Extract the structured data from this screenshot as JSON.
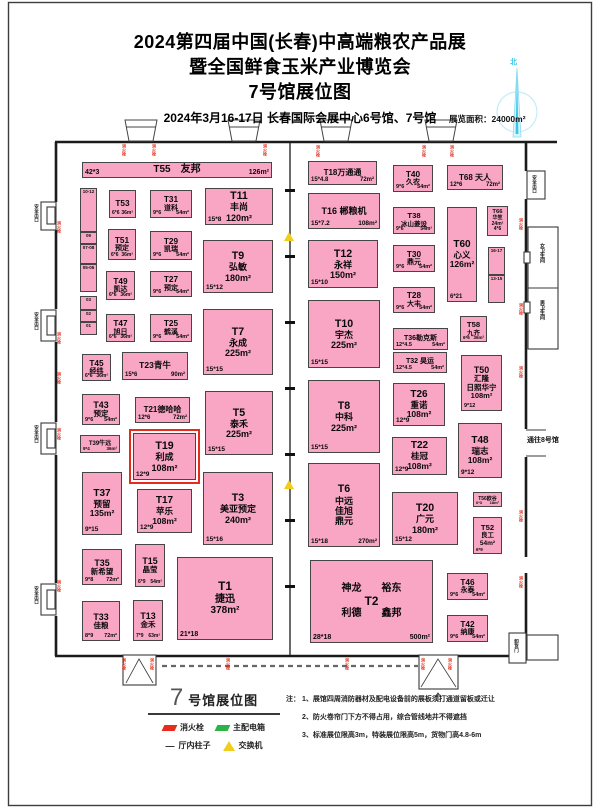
{
  "header": {
    "title1": "2024第四届中国(长春)中高端粮农产品展",
    "title2": "暨全国鲜食玉米产业博览会",
    "title3": "7号馆展位图",
    "date": "2024年3月16-17日  长春国际会展中心6号馆、7号馆",
    "area": "展览面积：24000m²",
    "compass": "北"
  },
  "colors": {
    "booth_pink": "#F8A6C3",
    "highlight_red": "#E62C1C",
    "hydrant_red": "#DD1414",
    "switch_yellow": "#F2CE1C",
    "distribution_green": "#2DB24A",
    "compass_cyan": "#39C6EA"
  },
  "map": {
    "booths": [
      {
        "id": "T55",
        "x": 82,
        "y": 162,
        "w": 190,
        "h": 16,
        "fs": 10,
        "cfs": 7,
        "lines": [
          "T55　友邦"
        ],
        "bl": "42*3",
        "br": "126m²"
      },
      {
        "id": "T53",
        "x": 109,
        "y": 190,
        "w": 27,
        "h": 28,
        "fs": 7,
        "cfs": 5,
        "lines": [
          "T53"
        ],
        "bl": "6*6",
        "br": "36m²"
      },
      {
        "id": "T31",
        "x": 150,
        "y": 190,
        "w": 42,
        "h": 28,
        "fs": 7,
        "cfs": 5.5,
        "lines": [
          "T31",
          "道科"
        ],
        "bl": "9*6",
        "br": "54m²"
      },
      {
        "id": "T11",
        "x": 205,
        "y": 188,
        "w": 68,
        "h": 37,
        "fs": 9,
        "cfs": 6.5,
        "lines": [
          "T11",
          "丰尚",
          "120m²"
        ],
        "bl": "15*8"
      },
      {
        "id": "T51",
        "x": 108,
        "y": 229,
        "w": 28,
        "h": 31,
        "fs": 7,
        "cfs": 5,
        "lines": [
          "T51",
          "预定"
        ],
        "bl": "6*6",
        "br": "36m²"
      },
      {
        "id": "T29",
        "x": 150,
        "y": 231,
        "w": 42,
        "h": 29,
        "fs": 7,
        "cfs": 5.5,
        "lines": [
          "T29",
          "凯瑞"
        ],
        "bl": "9*6",
        "br": "54m²"
      },
      {
        "id": "T9",
        "x": 203,
        "y": 240,
        "w": 70,
        "h": 53,
        "fs": 9,
        "cfs": 6.5,
        "lines": [
          "T9",
          "弘敏",
          "180m²"
        ],
        "bl": "15*12"
      },
      {
        "id": "T49",
        "x": 106,
        "y": 271,
        "w": 29,
        "h": 29,
        "fs": 7,
        "cfs": 5,
        "lines": [
          "T49",
          "凯达"
        ],
        "bl": "6*6",
        "br": "36m²"
      },
      {
        "id": "T27",
        "x": 150,
        "y": 271,
        "w": 42,
        "h": 26,
        "fs": 7,
        "cfs": 5.5,
        "lines": [
          "T27",
          "预定"
        ],
        "bl": "9*6",
        "br": "54m²"
      },
      {
        "id": "T47",
        "x": 106,
        "y": 314,
        "w": 29,
        "h": 28,
        "fs": 7,
        "cfs": 5,
        "lines": [
          "T47",
          "旭日"
        ],
        "bl": "6*6",
        "br": "36m²"
      },
      {
        "id": "T25",
        "x": 150,
        "y": 314,
        "w": 42,
        "h": 28,
        "fs": 7,
        "cfs": 5.5,
        "lines": [
          "T25",
          "鹤溪"
        ],
        "bl": "9*6",
        "br": "54m²"
      },
      {
        "id": "T7",
        "x": 203,
        "y": 309,
        "w": 70,
        "h": 66,
        "fs": 9,
        "cfs": 6.5,
        "lines": [
          "T7",
          "永成",
          "225m²"
        ],
        "bl": "15*15"
      },
      {
        "id": "T45",
        "x": 82,
        "y": 354,
        "w": 29,
        "h": 27,
        "fs": 7,
        "cfs": 5,
        "lines": [
          "T45",
          "经纬"
        ],
        "bl": "6*6",
        "br": "36m²"
      },
      {
        "id": "T23",
        "x": 122,
        "y": 352,
        "w": 66,
        "h": 28,
        "fs": 8.5,
        "cfs": 6,
        "lines": [
          "T23青牛"
        ],
        "bl": "15*6",
        "br": "90m²"
      },
      {
        "id": "T43",
        "x": 82,
        "y": 394,
        "w": 38,
        "h": 31,
        "fs": 7.5,
        "cfs": 5.5,
        "lines": [
          "T43",
          "预定"
        ],
        "bl": "9*6",
        "br": "54m²"
      },
      {
        "id": "T21",
        "x": 135,
        "y": 397,
        "w": 55,
        "h": 26,
        "fs": 8,
        "cfs": 6,
        "lines": [
          "T21德哈哈"
        ],
        "bl": "12*6",
        "br": "72m²"
      },
      {
        "id": "T5",
        "x": 205,
        "y": 391,
        "w": 68,
        "h": 64,
        "fs": 9,
        "cfs": 6.5,
        "lines": [
          "T5",
          "泰禾",
          "225m²"
        ],
        "bl": "15*15"
      },
      {
        "id": "T39",
        "x": 80,
        "y": 435,
        "w": 40,
        "h": 18,
        "fs": 6,
        "cfs": 4.5,
        "lines": [
          "T39牛远"
        ],
        "bl": "9*4",
        "br": "36m²"
      },
      {
        "id": "T19",
        "x": 133,
        "y": 433,
        "w": 63,
        "h": 47,
        "fs": 9,
        "cfs": 6.5,
        "hl": true,
        "lines": [
          "T19",
          "利成",
          "108m²"
        ],
        "bl": "12*9"
      },
      {
        "id": "T37",
        "x": 82,
        "y": 472,
        "w": 40,
        "h": 63,
        "fs": 8.5,
        "cfs": 6.5,
        "lines": [
          "T37",
          "预留",
          "135m²"
        ],
        "bl": "9*15"
      },
      {
        "id": "T17",
        "x": 137,
        "y": 489,
        "w": 55,
        "h": 44,
        "fs": 8.5,
        "cfs": 6.5,
        "lines": [
          "T17",
          "苹乐",
          "108m²"
        ],
        "bl": "12*9"
      },
      {
        "id": "T3",
        "x": 203,
        "y": 472,
        "w": 70,
        "h": 73,
        "fs": 9,
        "cfs": 6.5,
        "lines": [
          "T3",
          "美亚预定",
          "240m²"
        ],
        "bl": "15*16"
      },
      {
        "id": "T35",
        "x": 82,
        "y": 549,
        "w": 40,
        "h": 36,
        "fs": 7.5,
        "cfs": 5.5,
        "lines": [
          "T35",
          "新希望"
        ],
        "bl": "9*8",
        "br": "72m²"
      },
      {
        "id": "T15",
        "x": 135,
        "y": 544,
        "w": 30,
        "h": 43,
        "fs": 7.5,
        "cfs": 5,
        "lines": [
          "T15",
          "晶莹"
        ],
        "bl": "6*9",
        "br": "54m²"
      },
      {
        "id": "T1",
        "x": 177,
        "y": 557,
        "w": 96,
        "h": 83,
        "fs": 10,
        "cfs": 7,
        "lines": [
          "T1",
          "捷迅",
          "378m²"
        ],
        "bl": "21*18"
      },
      {
        "id": "T33",
        "x": 82,
        "y": 601,
        "w": 38,
        "h": 40,
        "fs": 7.5,
        "cfs": 5.5,
        "lines": [
          "T33",
          "佳粮"
        ],
        "bl": "8*9",
        "br": "72m²"
      },
      {
        "id": "T13",
        "x": 133,
        "y": 600,
        "w": 30,
        "h": 41,
        "fs": 7.5,
        "cfs": 5,
        "lines": [
          "T13",
          "金禾"
        ],
        "bl": "7*9",
        "br": "63m²"
      },
      {
        "id": "T18",
        "x": 308,
        "y": 161,
        "w": 69,
        "h": 24,
        "fs": 8,
        "cfs": 6,
        "lines": [
          "T18万通通"
        ],
        "bl": "15*4.8",
        "br": "72m²"
      },
      {
        "id": "T40",
        "x": 393,
        "y": 165,
        "w": 40,
        "h": 27,
        "fs": 7,
        "cfs": 5.5,
        "lines": [
          "T40",
          "久农"
        ],
        "bl": "9*6",
        "br": "54m²"
      },
      {
        "id": "T68",
        "x": 447,
        "y": 165,
        "w": 56,
        "h": 25,
        "fs": 8,
        "cfs": 6,
        "lines": [
          "T68 天人"
        ],
        "bl": "12*6",
        "br": "72m²"
      },
      {
        "id": "T16",
        "x": 308,
        "y": 193,
        "w": 72,
        "h": 36,
        "fs": 9,
        "cfs": 6.5,
        "lines": [
          "T16 郴粮机"
        ],
        "bl": "15*7.2",
        "br": "108m²"
      },
      {
        "id": "T38",
        "x": 393,
        "y": 207,
        "w": 42,
        "h": 27,
        "fs": 6.5,
        "cfs": 5,
        "lines": [
          "T38",
          "冰山菱设"
        ],
        "bl": "9*6",
        "br": "54m²"
      },
      {
        "id": "T66",
        "x": 487,
        "y": 206,
        "w": 21,
        "h": 30,
        "fs": 5,
        "cfs": 4,
        "lines": [
          "T66",
          "华笙",
          "24m²",
          "4*6"
        ]
      },
      {
        "id": "T60",
        "x": 447,
        "y": 207,
        "w": 30,
        "h": 95,
        "fs": 8.5,
        "cfs": 6,
        "lines": [
          "T60",
          "心义",
          "126m²"
        ],
        "bl": "6*21"
      },
      {
        "id": "T12",
        "x": 308,
        "y": 240,
        "w": 70,
        "h": 48,
        "fs": 9,
        "cfs": 6.5,
        "lines": [
          "T12",
          "永祥",
          "150m²"
        ],
        "bl": "15*10"
      },
      {
        "id": "T30",
        "x": 393,
        "y": 245,
        "w": 42,
        "h": 27,
        "fs": 7,
        "cfs": 5.5,
        "lines": [
          "T30",
          "鼎元"
        ],
        "bl": "9*6",
        "br": "54m²"
      },
      {
        "id": "T28",
        "x": 393,
        "y": 287,
        "w": 42,
        "h": 26,
        "fs": 7,
        "cfs": 5.5,
        "lines": [
          "T28",
          "大丰"
        ],
        "bl": "9*6",
        "br": "54m²"
      },
      {
        "id": "T58",
        "x": 460,
        "y": 316,
        "w": 27,
        "h": 26,
        "fs": 6.5,
        "cfs": 4.5,
        "lines": [
          "T58",
          "九齐"
        ],
        "bl": "6*6",
        "br": "36m²"
      },
      {
        "id": "T10",
        "x": 308,
        "y": 300,
        "w": 72,
        "h": 68,
        "fs": 9,
        "cfs": 6.5,
        "lines": [
          "T10",
          "宇杰",
          "225m²"
        ],
        "bl": "15*15"
      },
      {
        "id": "T36",
        "x": 393,
        "y": 328,
        "w": 55,
        "h": 22,
        "fs": 7,
        "cfs": 5.5,
        "lines": [
          "T36勒克斯"
        ],
        "bl": "12*4.5",
        "br": "54m²"
      },
      {
        "id": "T32",
        "x": 393,
        "y": 352,
        "w": 54,
        "h": 21,
        "fs": 7,
        "cfs": 5.5,
        "lines": [
          "T32 昊运"
        ],
        "bl": "12*4.5",
        "br": "54m²"
      },
      {
        "id": "T50",
        "x": 461,
        "y": 355,
        "w": 41,
        "h": 56,
        "fs": 7.5,
        "cfs": 5.5,
        "lines": [
          "T50",
          "汇隆",
          "日照华宁",
          "108m²"
        ],
        "bl": "9*12"
      },
      {
        "id": "T26",
        "x": 393,
        "y": 383,
        "w": 52,
        "h": 43,
        "fs": 8.5,
        "cfs": 6.5,
        "lines": [
          "T26",
          "重诺",
          "108m²"
        ],
        "bl": "12*9"
      },
      {
        "id": "T8",
        "x": 308,
        "y": 380,
        "w": 72,
        "h": 73,
        "fs": 9,
        "cfs": 6.5,
        "lines": [
          "T8",
          "中科",
          "225m²"
        ],
        "bl": "15*15"
      },
      {
        "id": "T22",
        "x": 392,
        "y": 437,
        "w": 55,
        "h": 38,
        "fs": 8.5,
        "cfs": 6.5,
        "lines": [
          "T22",
          "桂冠",
          "108m²"
        ],
        "bl": "12*9"
      },
      {
        "id": "T48",
        "x": 458,
        "y": 423,
        "w": 44,
        "h": 55,
        "fs": 8.5,
        "cfs": 6.5,
        "lines": [
          "T48",
          "瑞志",
          "108m²"
        ],
        "bl": "9*12"
      },
      {
        "id": "T6",
        "x": 308,
        "y": 463,
        "w": 72,
        "h": 84,
        "fs": 9,
        "cfs": 6.5,
        "lines": [
          "T6",
          "中远",
          "佳旭",
          "鼎元"
        ],
        "bl": "15*18",
        "br": "270m²"
      },
      {
        "id": "T20",
        "x": 392,
        "y": 492,
        "w": 66,
        "h": 53,
        "fs": 9,
        "cfs": 6.5,
        "lines": [
          "T20",
          "广元",
          "180m²"
        ],
        "bl": "15*12"
      },
      {
        "id": "T56",
        "x": 473,
        "y": 492,
        "w": 29,
        "h": 15,
        "fs": 5,
        "cfs": 4,
        "lines": [
          "T56欧谷"
        ],
        "bl": "6*3",
        "br": "18m²"
      },
      {
        "id": "T52",
        "x": 473,
        "y": 517,
        "w": 29,
        "h": 37,
        "fs": 6.5,
        "cfs": 4.5,
        "lines": [
          "T52",
          "良工",
          "54m²"
        ],
        "bl": "6*9"
      },
      {
        "id": "T46",
        "x": 447,
        "y": 573,
        "w": 41,
        "h": 27,
        "fs": 7,
        "cfs": 5.5,
        "lines": [
          "T46",
          "永泰"
        ],
        "bl": "9*6",
        "br": "54m²"
      },
      {
        "id": "T42",
        "x": 447,
        "y": 615,
        "w": 41,
        "h": 27,
        "fs": 7,
        "cfs": 5.5,
        "lines": [
          "T42",
          "纳康"
        ],
        "bl": "9*6",
        "br": "54m²"
      },
      {
        "id": "T2",
        "x": 310,
        "y": 560,
        "w": 123,
        "h": 83,
        "fs": 10,
        "cfs": 7,
        "lines": [
          "神龙　　裕东",
          "T2",
          "利德　　鑫邦"
        ],
        "bl": "28*18",
        "br": "500m²"
      }
    ],
    "strips": [
      {
        "x": 80,
        "w": 17,
        "segs": [
          {
            "t": "10-12",
            "y": 188,
            "h": 44
          },
          {
            "t": "09",
            "y": 232,
            "h": 12
          },
          {
            "t": "07-08",
            "y": 244,
            "h": 20
          },
          {
            "t": "05-06",
            "y": 264,
            "h": 28
          },
          {
            "t": "03",
            "y": 296,
            "h": 14
          },
          {
            "t": "02",
            "y": 310,
            "h": 12
          },
          {
            "t": "01",
            "y": 322,
            "h": 13
          }
        ]
      },
      {
        "x": 488,
        "w": 17,
        "segs": [
          {
            "t": "16-17",
            "y": 247,
            "h": 28
          },
          {
            "t": "13-15",
            "y": 275,
            "h": 28
          }
        ]
      }
    ],
    "labels": [
      {
        "t": "安全出口",
        "x": 34,
        "y": 204,
        "o": "v",
        "fs": 4.5
      },
      {
        "t": "安全出口",
        "x": 34,
        "y": 312,
        "o": "v",
        "fs": 4.5
      },
      {
        "t": "安全出口",
        "x": 34,
        "y": 425,
        "o": "v",
        "fs": 4.5
      },
      {
        "t": "安全出口",
        "x": 34,
        "y": 586,
        "o": "v",
        "fs": 4.5
      },
      {
        "t": "安全出口",
        "x": 532,
        "y": 175,
        "o": "v",
        "fs": 4.5
      },
      {
        "t": "女卫生间",
        "x": 539,
        "y": 243,
        "o": "v",
        "fs": 5
      },
      {
        "t": "男卫生间",
        "x": 539,
        "y": 300,
        "o": "v",
        "fs": 5
      },
      {
        "t": "通往8号馆",
        "x": 527,
        "y": 437,
        "o": "h",
        "fs": 7
      },
      {
        "t": "卸货门",
        "x": 514,
        "y": 639,
        "o": "v",
        "fs": 4.5
      }
    ],
    "hydrants": [
      [
        122,
        144
      ],
      [
        152,
        144
      ],
      [
        263,
        144
      ],
      [
        316,
        145
      ],
      [
        422,
        145
      ],
      [
        450,
        145
      ],
      [
        57,
        221
      ],
      [
        57,
        332
      ],
      [
        57,
        372
      ],
      [
        57,
        428
      ],
      [
        57,
        580
      ],
      [
        519,
        218
      ],
      [
        519,
        303
      ],
      [
        519,
        366
      ],
      [
        519,
        510
      ],
      [
        519,
        576
      ],
      [
        122,
        658
      ],
      [
        150,
        658
      ],
      [
        226,
        658
      ],
      [
        345,
        658
      ],
      [
        421,
        658
      ],
      [
        448,
        658
      ]
    ],
    "switches": [
      [
        284,
        232
      ],
      [
        284,
        480
      ]
    ],
    "hydrant_glyph": "消火栓"
  },
  "legend": {
    "title_num": "7",
    "title_text": "号馆展位图",
    "items": [
      {
        "icon": "fire-hydrant",
        "label": "消火栓"
      },
      {
        "icon": "main-distribution-box",
        "label": "主配电箱"
      },
      {
        "icon": "hall-column",
        "label": "厅内柱子",
        "glyph": "—"
      },
      {
        "icon": "switch",
        "label": "交换机"
      }
    ]
  },
  "notes": {
    "prefix": "注：",
    "lines": [
      "1、展馆四周消防器材及配电设备前的展板须打通道留板或迁让",
      "2、防火卷帘门下方不得占用，综合管线地井不得遮挡",
      "3、标准展位限高3m，特装展位限高5m，货物门高4.8-6m"
    ]
  }
}
